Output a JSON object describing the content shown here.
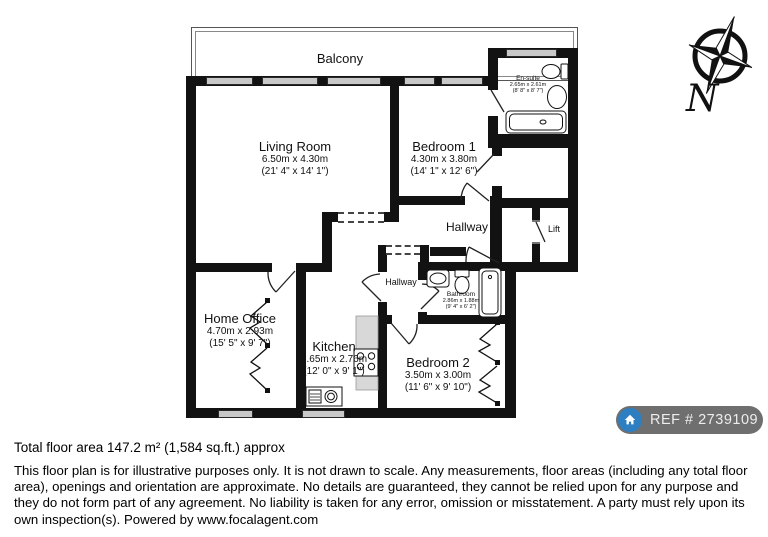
{
  "plan": {
    "balcony": {
      "name": "Balcony"
    },
    "living_room": {
      "name": "Living Room",
      "metric": "6.50m x 4.30m",
      "imperial": "(21' 4\" x 14' 1\")"
    },
    "bedroom1": {
      "name": "Bedroom 1",
      "metric": "4.30m x 3.80m",
      "imperial": "(14' 1\" x 12' 6\")"
    },
    "ensuite": {
      "name": "En-suite",
      "metric": "2.65m x 2.61m",
      "imperial": "(8' 8\" x 8' 7\")"
    },
    "hallway_upper": {
      "name": "Hallway"
    },
    "hallway_lower": {
      "name": "Hallway"
    },
    "lift": {
      "name": "Lift"
    },
    "bathroom": {
      "name": "Bathroom",
      "metric": "2.86m x 1.88m",
      "imperial": "(9' 4\" x 6' 2\")"
    },
    "home_office": {
      "name": "Home Office",
      "metric": "4.70m x 2.93m",
      "imperial": "(15' 5\" x 9' 7\")"
    },
    "kitchen": {
      "name": "Kitchen",
      "metric": "3.65m x 2.76m",
      "imperial": "(12' 0\" x 9' 1\")"
    },
    "bedroom2": {
      "name": "Bedroom 2",
      "metric": "3.50m x 3.00m",
      "imperial": "(11' 6\" x 9' 10\")"
    }
  },
  "compass": {
    "north_label": "N"
  },
  "ref_badge": {
    "label": "REF # 2739109"
  },
  "footer": {
    "total_area": "Total floor area 147.2 m² (1,584 sq.ft.) approx",
    "disclaimer": "This floor plan is for illustrative purposes only. It is not drawn to scale. Any measurements, floor areas (including any total floor area), openings and orientation are approximate. No details are guaranteed, they cannot be relied upon for any purpose and they do not form part of any agreement. No liability is taken for any error, omission or misstatement. A party must rely upon its own inspection(s). Powered by www.focalagent.com"
  },
  "colors": {
    "wall": "#121212",
    "window_fill": "#c8c8c8",
    "counter_fill": "#d8d8d8",
    "badge_bg": "#6f6f6f",
    "badge_icon_bg": "#2e7fc2",
    "badge_text": "#ededed"
  }
}
